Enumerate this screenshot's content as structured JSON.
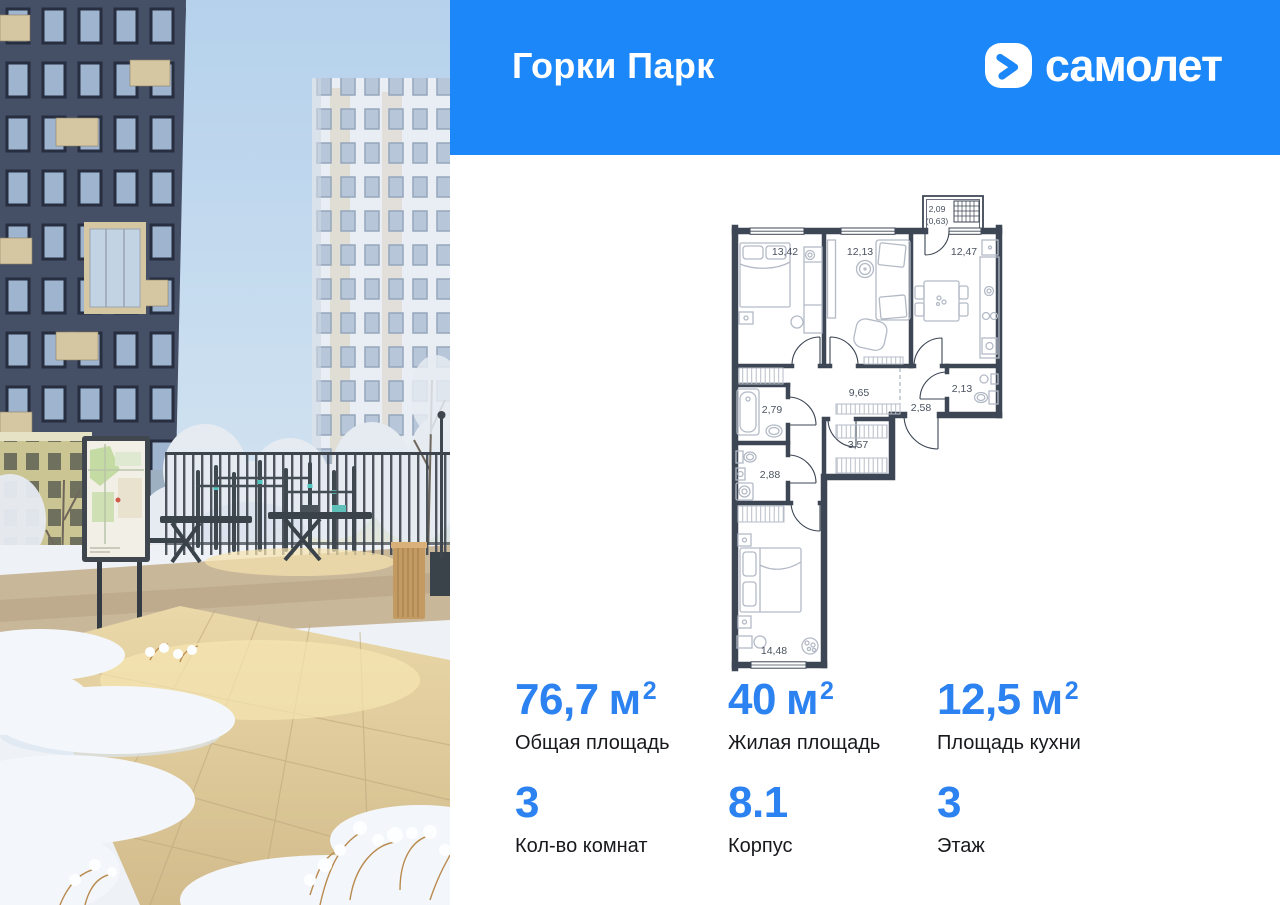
{
  "header": {
    "project_name": "Горки Парк",
    "brand_wordmark": "самолет"
  },
  "colors": {
    "band_blue": "#1b87f8",
    "stat_blue": "#2b82f0",
    "plan_wall": "#3d4654"
  },
  "floorplan": {
    "balcony": {
      "area": "2,09",
      "reduced_area": "(0,63)"
    },
    "rooms": [
      {
        "name": "bedroom-1",
        "area": "13,42"
      },
      {
        "name": "living-room",
        "area": "12,13"
      },
      {
        "name": "kitchen",
        "area": "12,47"
      },
      {
        "name": "hallway",
        "area": "9,65"
      },
      {
        "name": "bathroom",
        "area": "2,79"
      },
      {
        "name": "toilet",
        "area": "2,13"
      },
      {
        "name": "entry-hall",
        "area": "2,58"
      },
      {
        "name": "storage",
        "area": "3,57"
      },
      {
        "name": "wc",
        "area": "2,88"
      },
      {
        "name": "bedroom-2",
        "area": "14,48"
      }
    ]
  },
  "stats": {
    "row1": [
      {
        "value": "76,7",
        "unit": "м",
        "sup": "2",
        "label": "Общая площадь"
      },
      {
        "value": "40",
        "unit": "м",
        "sup": "2",
        "label": "Жилая площадь"
      },
      {
        "value": "12,5",
        "unit": "м",
        "sup": "2",
        "label": "Площадь кухни"
      }
    ],
    "row2": [
      {
        "value": "3",
        "label": "Кол-во комнат"
      },
      {
        "value": "8.1",
        "label": "Корпус"
      },
      {
        "value": "3",
        "label": "Этаж"
      }
    ]
  }
}
